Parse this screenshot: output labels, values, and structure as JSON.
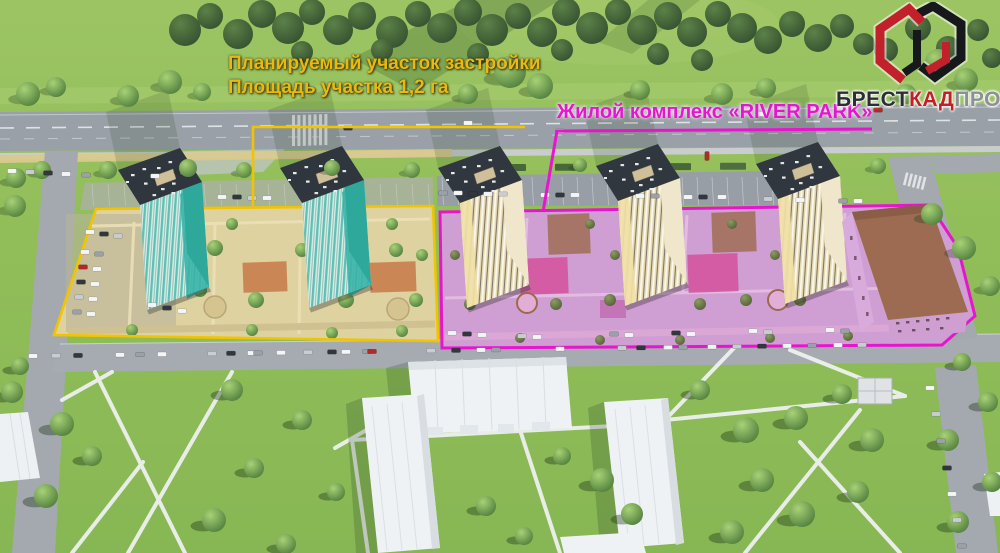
{
  "annotations": {
    "planned_site": {
      "line1": "Планируемый участок застройки",
      "line2": "Площадь участка 1,2 га",
      "color": "#e9b90f",
      "outline_color": "#f2c400"
    },
    "river_park": {
      "label": "Жилой комплекс «RIVER PARK»",
      "color": "#e716ce",
      "outline_color": "#e716ce"
    }
  },
  "logo": {
    "brest": "БРЕСТ",
    "kad": "КАД",
    "proekt": "ПРОЕКТ",
    "colors": {
      "brest": "#2b2e33",
      "kad": "#c41e26",
      "proekt": "#8d9094"
    }
  },
  "scene": {
    "description": "Aerial 3D render of residential development",
    "sites": [
      {
        "name": "planned-site",
        "outline_color": "#f2c400",
        "tall_buildings": 2
      },
      {
        "name": "river-park",
        "outline_color": "#e716ce",
        "tall_buildings": 3,
        "low_buildings": 1
      }
    ]
  }
}
